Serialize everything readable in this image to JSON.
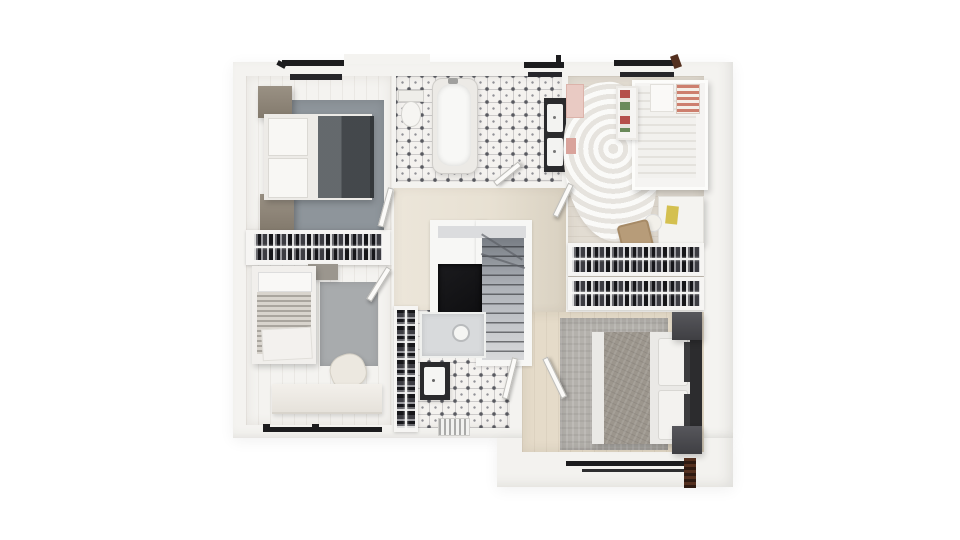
{
  "scene": {
    "type": "architectural-floor-plan-render",
    "view": "top-down-3d",
    "description": "Photorealistic upper-storey floor plan on white background: three bedrooms plus master bedroom, family bathroom, shower room, walk-through closet, staircase and landing",
    "background_color": "#ffffff"
  },
  "palette": {
    "wall": "#f4f3f0",
    "floor_cream": "#e9e2d3",
    "floor_wood_light": "#e2dcd2",
    "floor_wood_warm": "#e5dbc9",
    "tile_white": "#f4f2ef",
    "tile_motif": "#595a60",
    "rug_gray_blue": "#8e959b",
    "rug_gray": "#b4b1ac",
    "duvet_dark_gray": "#4d5155",
    "wood_furniture": "#8e8578",
    "closet_dark": "#3c3c40",
    "stair_void": "#141416",
    "window_frame": "#1c1c1e",
    "window_wood_jamb": "#54301f",
    "accent_stripe_red": "#cd7f6e",
    "accent_yellow": "#d4c050",
    "accent_pink": "#e9cac3",
    "basket_tan": "#b79c79"
  },
  "rooms": [
    {
      "name": "bedroom-top-left",
      "furniture": [
        "double bed with dark gray duvet",
        "two white pillows",
        "two wood nightstands",
        "gray-blue rug",
        "clothes-rail closet"
      ]
    },
    {
      "name": "family-bathroom",
      "furniture": [
        "freestanding bathtub",
        "toilet",
        "double-basin vanity",
        "patterned tile floor"
      ]
    },
    {
      "name": "kids-bedroom",
      "furniture": [
        "white bed",
        "red striped pillow",
        "bookshelf with colorful books",
        "fluffy white rug",
        "desk",
        "storage basket",
        "pink wall shelf"
      ]
    },
    {
      "name": "bedroom-bottom-left",
      "furniture": [
        "single bed with striped blanket",
        "gray rug",
        "armchair",
        "low bench",
        "wall shelf"
      ]
    },
    {
      "name": "shower-room",
      "furniture": [
        "walk-in shower",
        "washbasin on dark counter",
        "clothes rail",
        "radiator",
        "patterned tile floor"
      ]
    },
    {
      "name": "master-bedroom",
      "furniture": [
        "double bed",
        "gray textured throw",
        "dark headboard",
        "two dark nightstands",
        "large gray rug"
      ]
    },
    {
      "name": "landing",
      "furniture": []
    },
    {
      "name": "staircase",
      "furniture": [
        "winder treads",
        "stairwell void"
      ]
    },
    {
      "name": "walk-through-closet",
      "furniture": [
        "upper clothes rail",
        "lower clothes rail"
      ]
    }
  ],
  "openings": {
    "windows_top_wall": 3,
    "windows_bottom_left_wall": 1,
    "windows_bottom_right_wall": 1,
    "interior_doors": 6
  }
}
